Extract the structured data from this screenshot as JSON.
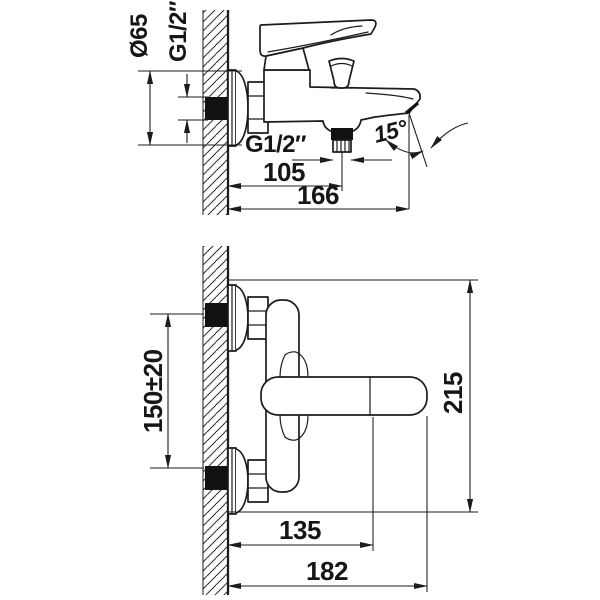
{
  "drawing_title": "wall-mounted bath mixer dimension drawing",
  "colors": {
    "line": "#1c1c1c",
    "paper": "#ffffff",
    "solid_fill": "#111111"
  },
  "labels": {
    "side_view": {
      "flange_diameter": "Ø65",
      "wall_thread": "G1/2″",
      "outlet_thread": "G1/2″",
      "wall_to_outlet": "105",
      "wall_to_spout_tip": "166",
      "spout_angle": "15°"
    },
    "front_view": {
      "connection_spacing": "150±20",
      "overall_height": "215",
      "wall_to_handle_axis": "135",
      "wall_to_handle_tip": "182"
    }
  }
}
